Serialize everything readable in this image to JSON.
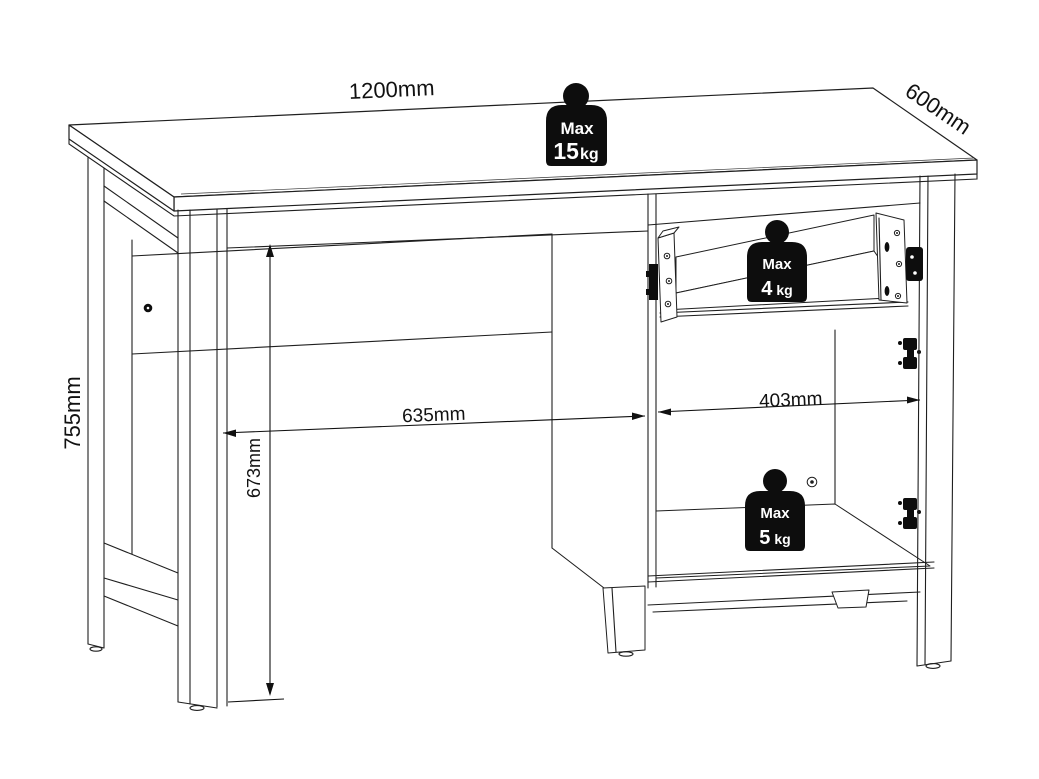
{
  "drawing": {
    "subject": "desk-technical-drawing",
    "dimensions": {
      "width_label": "1200mm",
      "depth_label": "600mm",
      "height_label": "755mm",
      "knee_width_label": "635mm",
      "cabinet_width_label": "403mm",
      "knee_height_label": "673mm"
    },
    "load_limits": {
      "desktop": {
        "label": "Max",
        "value": "15",
        "unit": "kg"
      },
      "drawer": {
        "label": "Max",
        "value": "4",
        "unit": "kg"
      },
      "cabinet": {
        "label": "Max",
        "value": "5",
        "unit": "kg"
      }
    },
    "colors": {
      "line": "#1f1f1f",
      "background": "#ffffff",
      "weight_badge": "#0d0d0d",
      "weight_text": "#ffffff"
    }
  }
}
